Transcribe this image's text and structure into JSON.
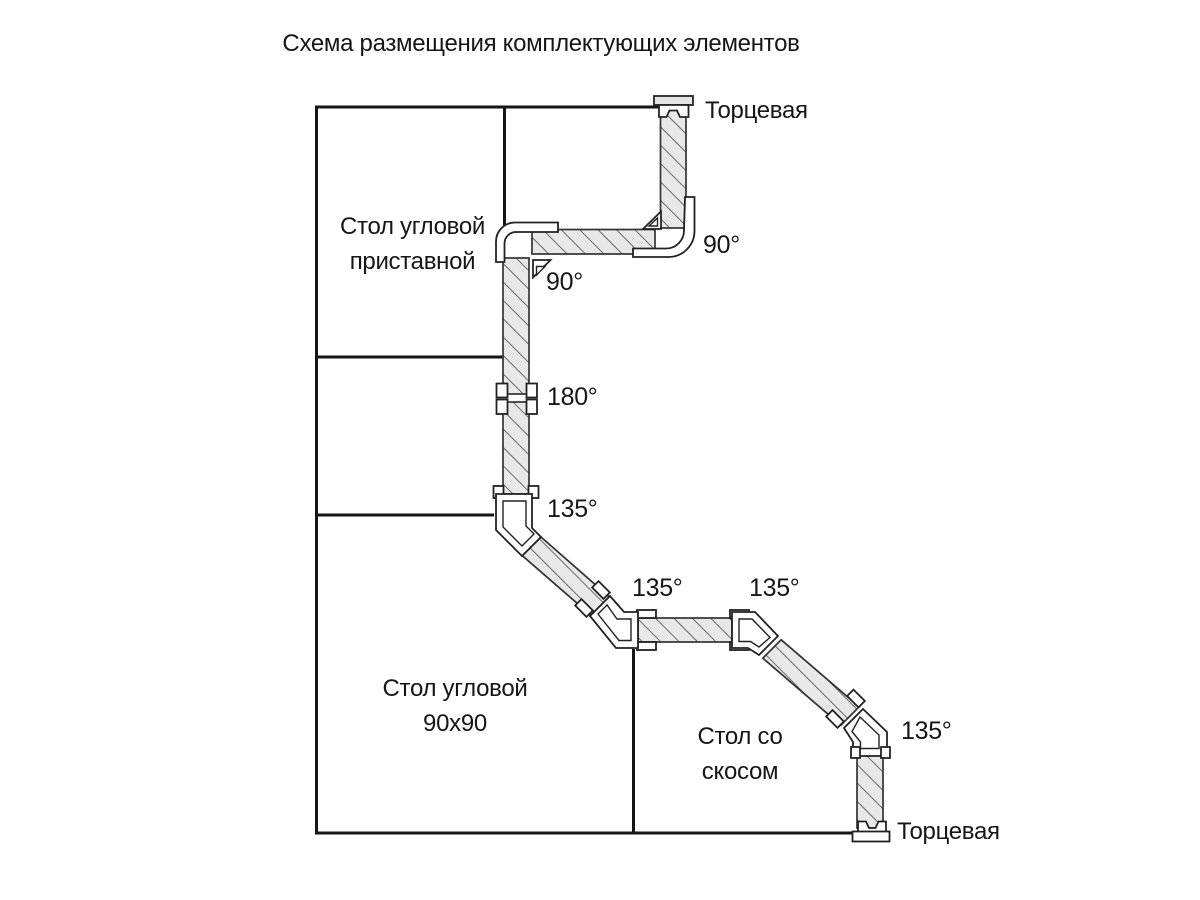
{
  "title": "Схема размещения комплектующих элементов",
  "tables": [
    {
      "id": "corner-attached",
      "line1": "Стол угловой",
      "line2": "приставной"
    },
    {
      "id": "corner-90x90",
      "line1": "Стол угловой",
      "line2": "90х90"
    },
    {
      "id": "bevel",
      "line1": "Стол со",
      "line2": "скосом"
    }
  ],
  "angles": [
    {
      "id": "top-right-90",
      "value": "90°"
    },
    {
      "id": "top-left-90",
      "value": "90°"
    },
    {
      "id": "straight-180",
      "value": "180°"
    },
    {
      "id": "bend-135-first",
      "value": "135°"
    },
    {
      "id": "bend-135-second",
      "value": "135°"
    },
    {
      "id": "bend-135-third",
      "value": "135°"
    },
    {
      "id": "bend-135-fourth",
      "value": "135°"
    }
  ],
  "end_caps": [
    {
      "id": "top",
      "label": "Торцевая"
    },
    {
      "id": "bottom",
      "label": "Торцевая"
    }
  ],
  "colors": {
    "outline": "#161616",
    "strip_fill": "#e8e8e8",
    "hatch_line": "#4a4a4a",
    "connector_fill": "#ffffff",
    "text": "#161616",
    "background": "#ffffff"
  }
}
